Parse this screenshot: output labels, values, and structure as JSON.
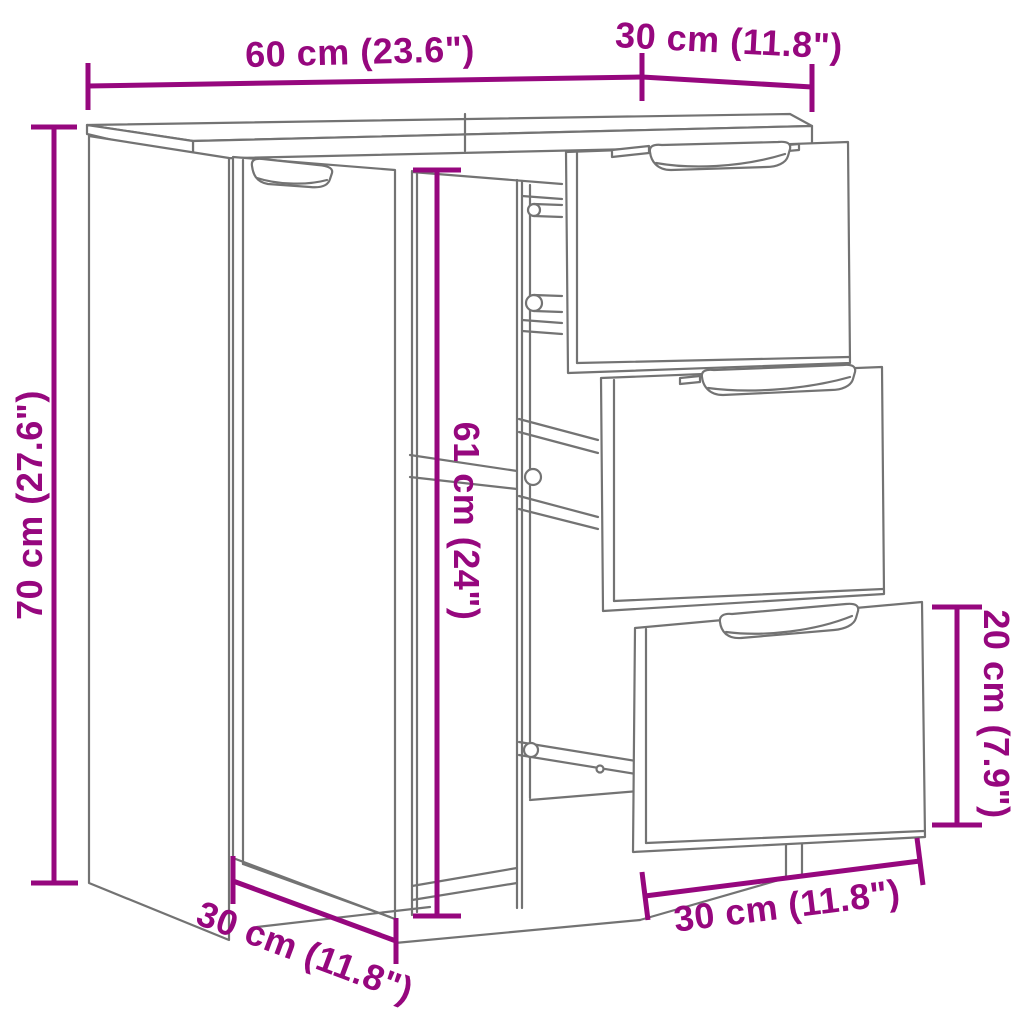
{
  "diagram": {
    "type": "product-dimension-diagram",
    "subject": "sideboard-with-door-and-3-drawers"
  },
  "colors": {
    "dimension_annotation": "#96077E",
    "linework": "#737373",
    "background": "#FFFFFF"
  },
  "labels": {
    "top_width": "60 cm (23.6\")",
    "top_depth": "30 cm (11.8\")",
    "height": "70 cm (27.6\")",
    "interior_height": "61 cm (24\")",
    "drawer_section_height": "20 cm (7.9\")",
    "bottom_depth": "30 cm (11.8\")",
    "bottom_width": "30 cm (11.8\")"
  },
  "product_dimensions": {
    "overall_width": {
      "cm": 60,
      "inch": 23.6
    },
    "top_depth": {
      "cm": 30,
      "inch": 11.8
    },
    "overall_height": {
      "cm": 70,
      "inch": 27.6
    },
    "interior_height": {
      "cm": 61,
      "inch": 24
    },
    "drawer_section_height": {
      "cm": 20,
      "inch": 7.9
    },
    "bottom_depth": {
      "cm": 30,
      "inch": 11.8
    },
    "drawer_section_width": {
      "cm": 30,
      "inch": 11.8
    }
  }
}
